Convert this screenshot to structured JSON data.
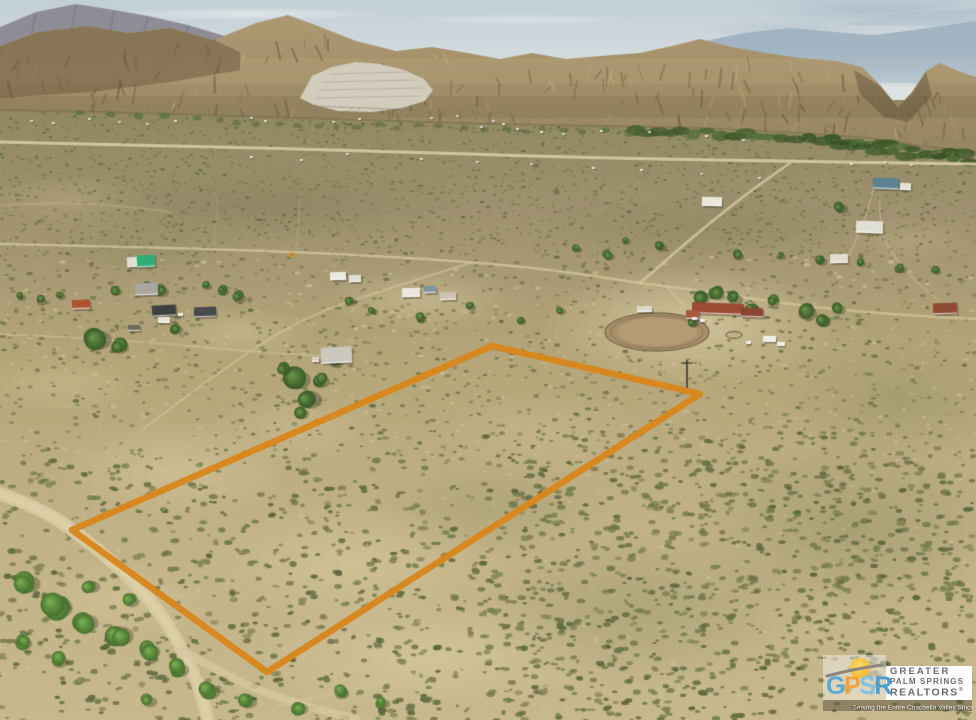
{
  "type": "real-estate-aerial-photo",
  "scene": {
    "description": "Aerial drone view of a vacant desert land parcel outlined in orange, with scattered rural homes, a horse arena, dirt roads and a rugged mountain range in the background",
    "sky_color": "#c6d2d9",
    "mountain_color": "#a8936f",
    "desert_color": "#b7a77c"
  },
  "property_boundary": {
    "color": "#D8861B",
    "stroke_width": 6.5,
    "points": [
      [
        72,
        530
      ],
      [
        492,
        346
      ],
      [
        700,
        394
      ],
      [
        267,
        672
      ]
    ]
  },
  "logo": {
    "acronym_letters": [
      {
        "letter": "G",
        "color": "#5AA9D8"
      },
      {
        "letter": "P",
        "color": "#F2A23A"
      },
      {
        "letter": "S",
        "color": "#7FC3E8"
      },
      {
        "letter": "R",
        "color": "#4A9FD0"
      }
    ],
    "org_line1": "GREATER",
    "org_line2": "PALM SPRINGS",
    "org_line3": "REALTORS",
    "registered_mark": "®",
    "tagline": "Serving the Entire Coachella Valley Since 1929"
  }
}
